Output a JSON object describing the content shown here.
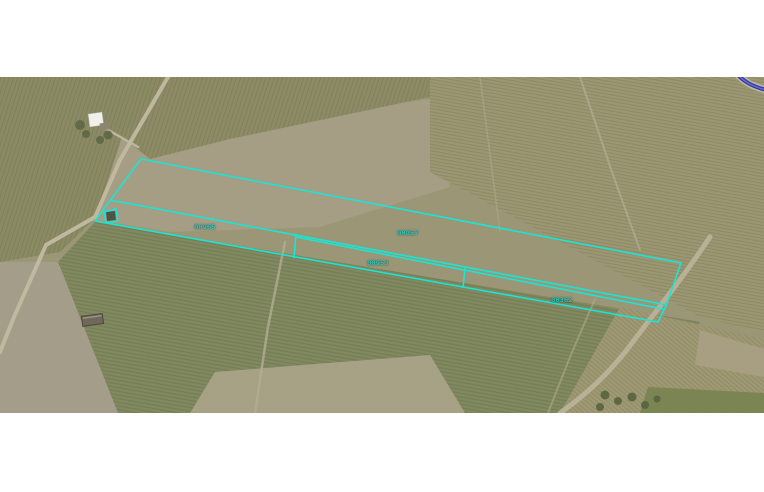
{
  "map": {
    "description": "aerial farmland imagery with cyan cadastral parcel overlay",
    "parcels": [
      {
        "id": "00965"
      },
      {
        "id": "00957"
      },
      {
        "id": "00953"
      },
      {
        "id": "00362"
      }
    ],
    "colors": {
      "parcel_outline": "#1ae5d5",
      "parcel_label": "#20efe0",
      "road_overlay_line": "#303a9e",
      "imagery_base": "#9b9676",
      "letterbox": "#ffffff"
    }
  }
}
